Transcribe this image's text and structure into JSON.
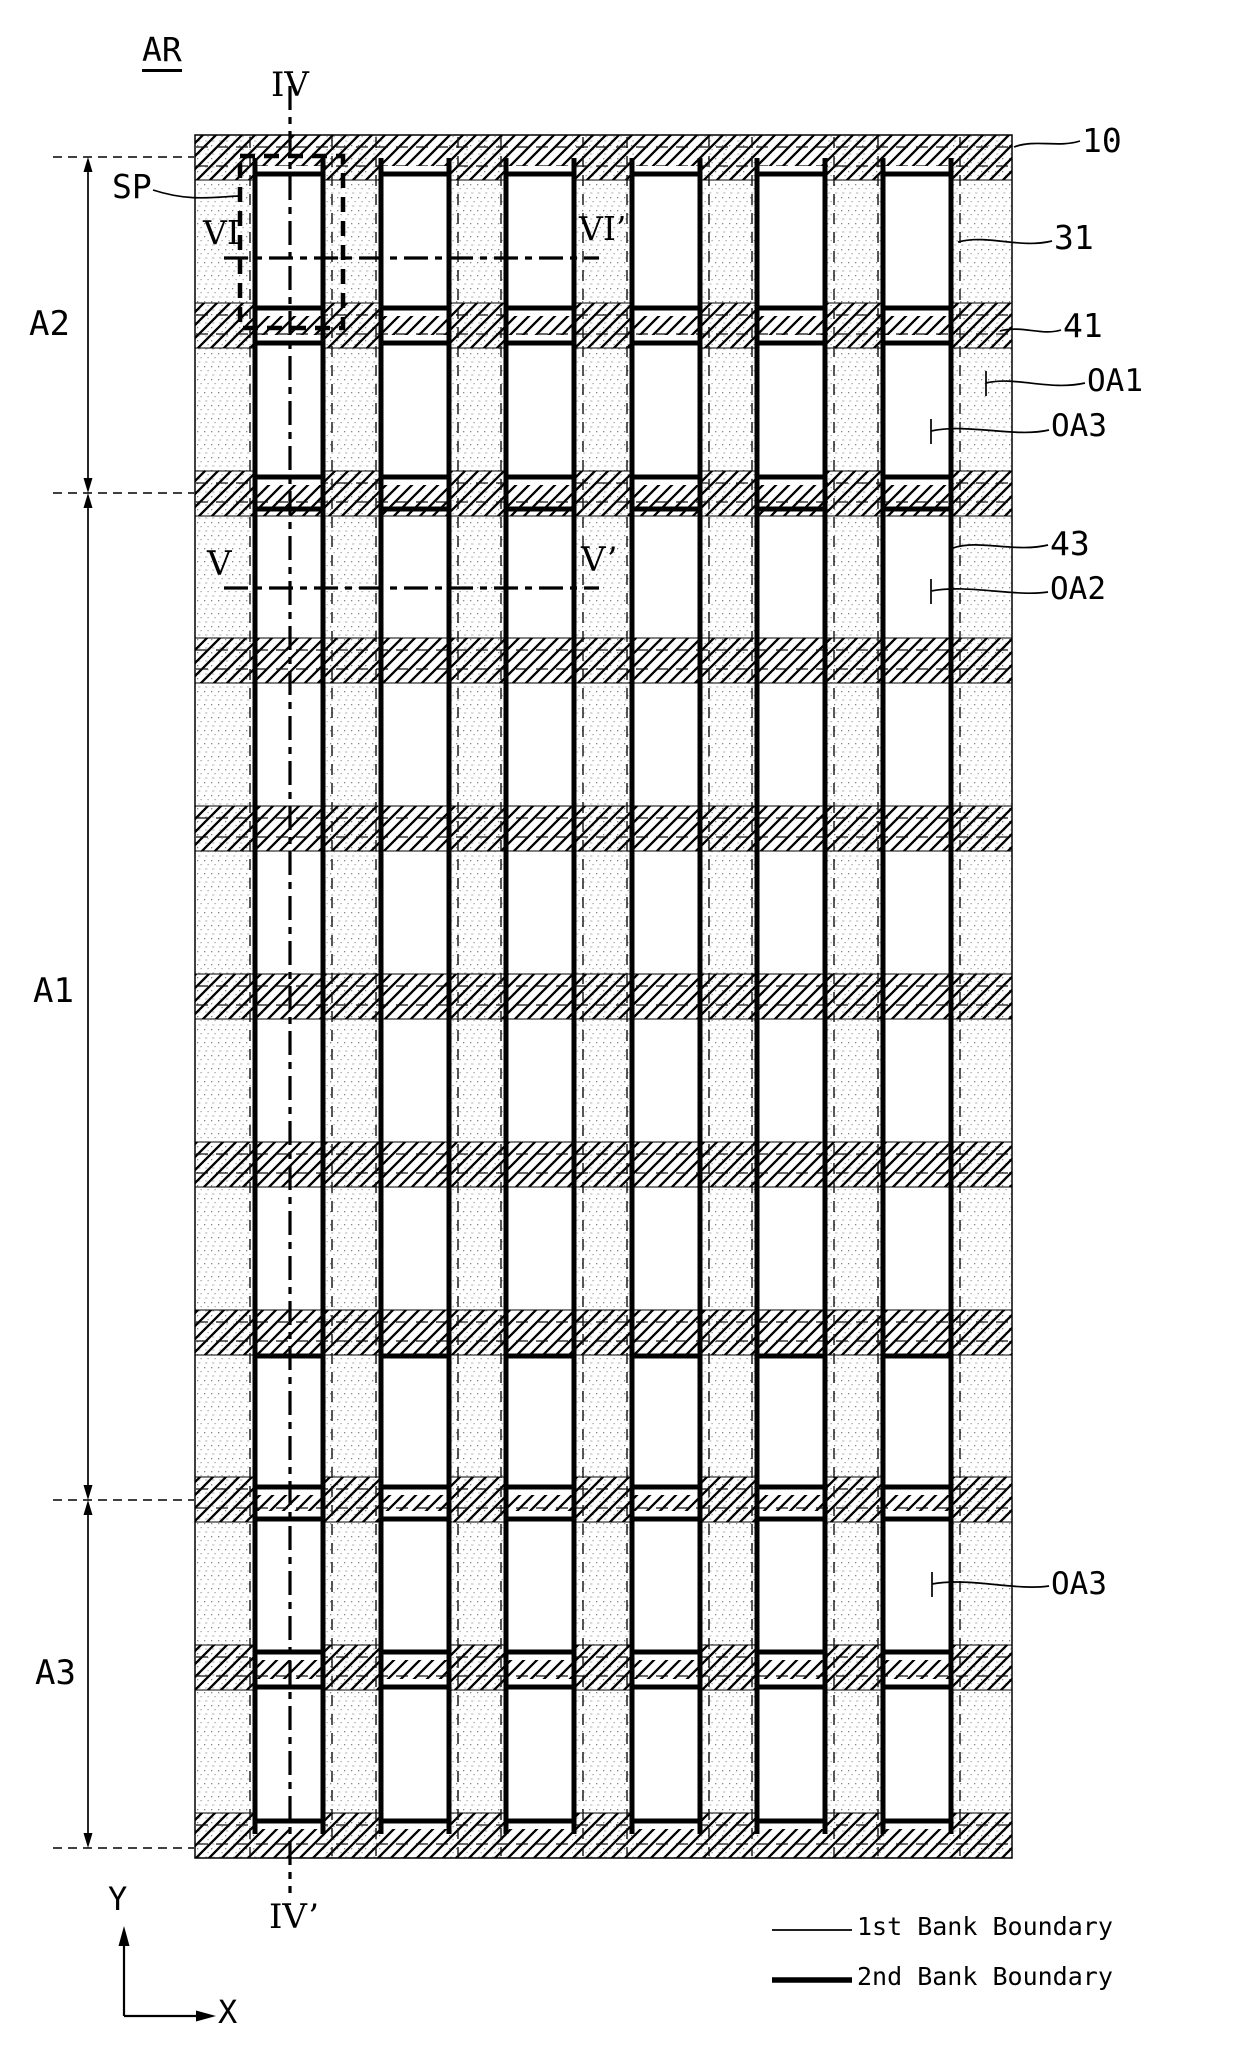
{
  "figure_title": "AR",
  "subpixel_label": "SP",
  "regions": {
    "a2": "A2",
    "a1": "A1",
    "a3": "A3"
  },
  "section_markers": {
    "iv": "IV",
    "iv_prime": "IV’",
    "v": "V",
    "v_prime": "V’",
    "vi": "VI",
    "vi_prime": "VI’"
  },
  "callouts": {
    "c10": "10",
    "c31": "31",
    "c41": "41",
    "cOA1": "OA1",
    "cOA3_upper": "OA3",
    "c43": "43",
    "cOA2": "OA2",
    "cOA3_lower": "OA3"
  },
  "axis": {
    "x": "X",
    "y": "Y"
  },
  "legend": {
    "items": [
      {
        "line_style": "thin",
        "label": "1st Bank Boundary"
      },
      {
        "line_style": "thick",
        "label": "2nd Bank Boundary"
      }
    ]
  },
  "colors": {
    "ink": "#000000",
    "stipple_dot": "#8f8f8f",
    "background": "#ffffff"
  }
}
